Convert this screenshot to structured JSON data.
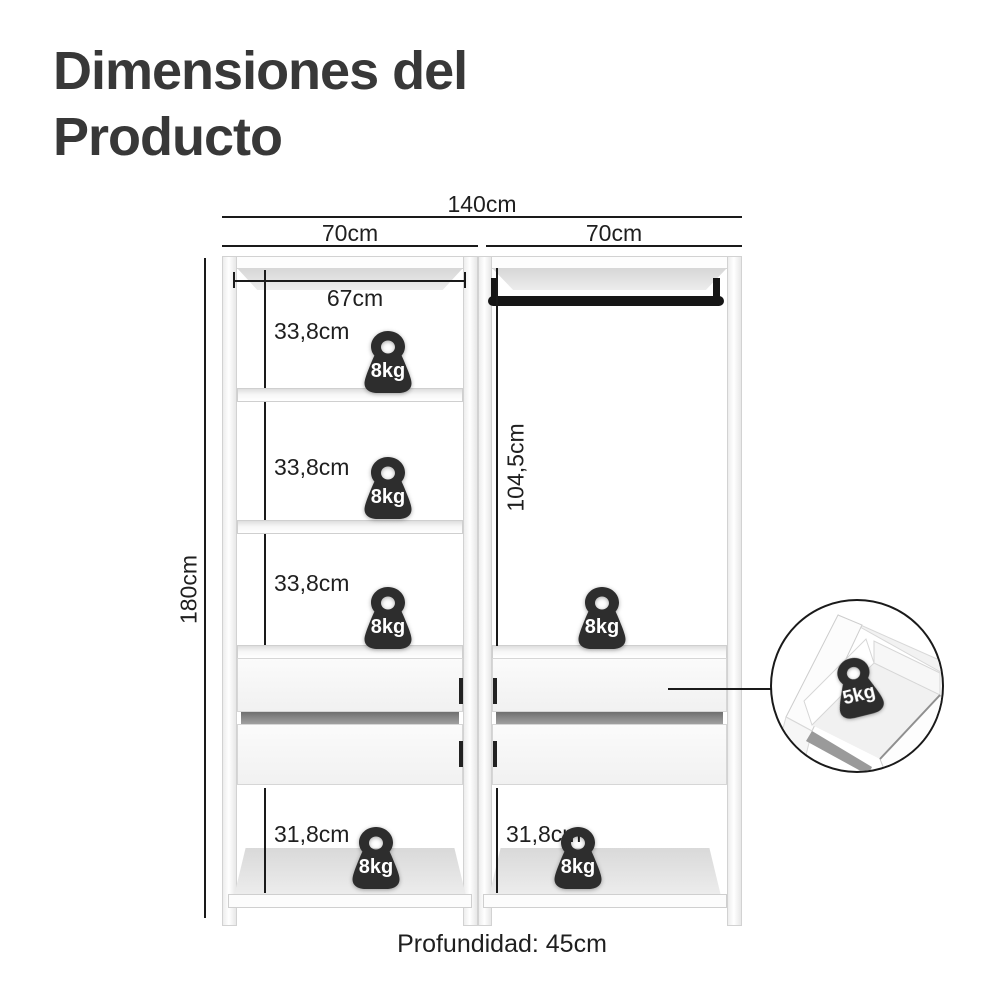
{
  "title": {
    "line1": "Dimensiones del",
    "line2": "Producto"
  },
  "top_dimensions": {
    "total_width": "140cm",
    "column_widths": [
      "70cm",
      "70cm"
    ]
  },
  "left_column": {
    "inner_width": "67cm",
    "opening_heights": [
      "33,8cm",
      "33,8cm",
      "33,8cm"
    ],
    "bottom_opening_height": "31,8cm"
  },
  "right_column": {
    "hanging_height": "104,5cm",
    "bottom_opening_height": "31,8cm"
  },
  "overall": {
    "height": "180cm",
    "depth_label": "Profundidad: 45cm"
  },
  "weights": {
    "shelf_badge": "8kg",
    "drawer_badge": "5kg"
  },
  "colors": {
    "line": "#1a1a1a",
    "title_text": "#383838",
    "body_text": "#1f1f1f",
    "furniture_border": "#cfcfcf",
    "furniture_shading": "#e2e2e2",
    "weight_fill": "#2d2d2d",
    "rod": "#161616"
  }
}
